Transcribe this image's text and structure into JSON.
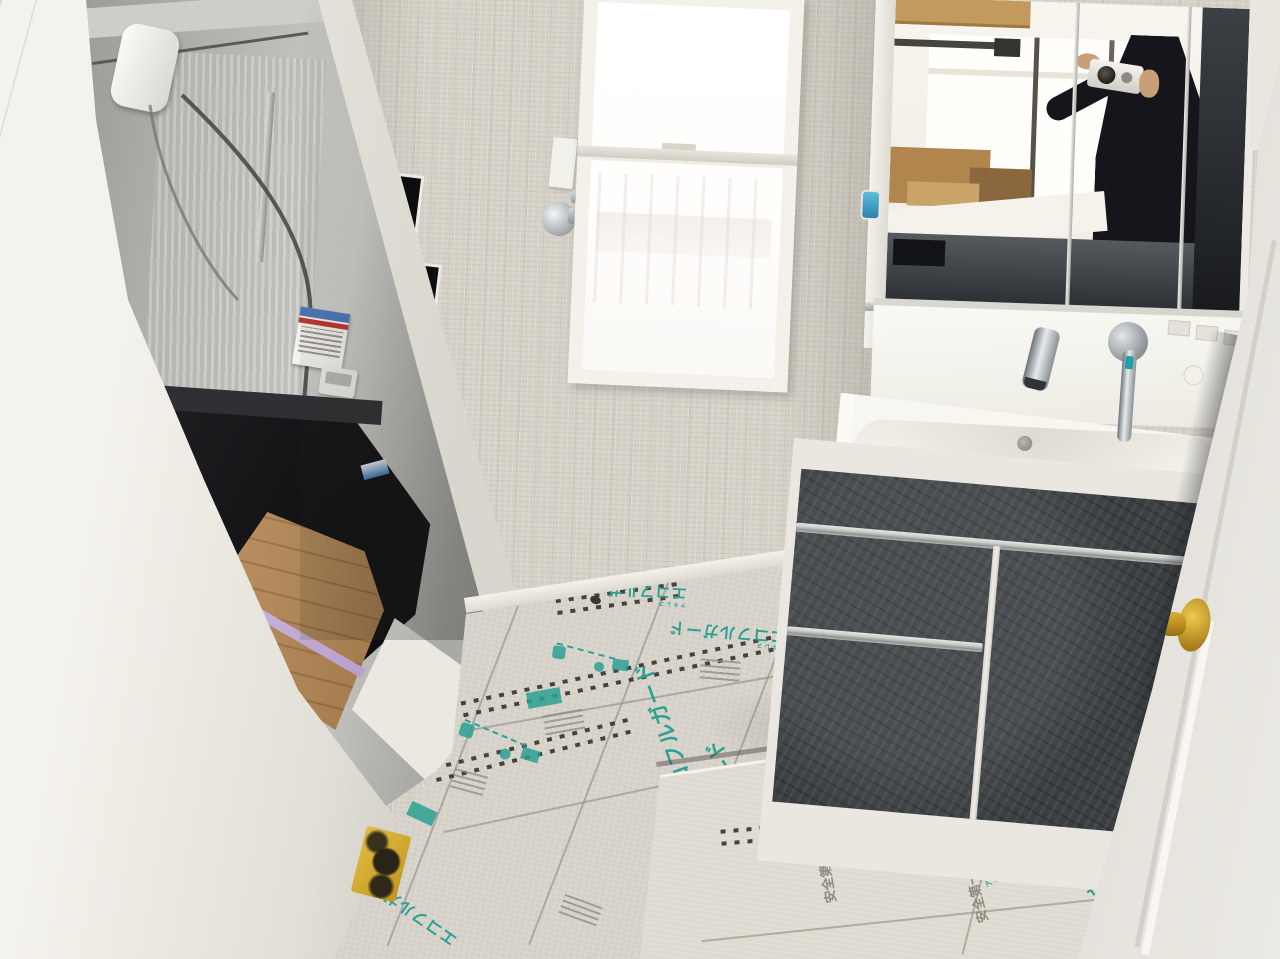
{
  "floor_protection": {
    "brand_text": "エコフルガード",
    "brand_prefix": "アキレス",
    "safety_text": "安全第一",
    "print_color": "#2ba093",
    "sheet_color": "#d7d3ca",
    "lifted_sheet_color": "#dedacf"
  },
  "palette": {
    "wallpaper": "#d6d2c8",
    "frame_white": "#eeece6",
    "bath_wall_gray": "#b5b5b1",
    "bathtub_black": "#17171a",
    "wood_threshold": "#b08a5c",
    "threshold_purple": "#c5aed6",
    "vanity_dark_front": "#3b3f42",
    "handle_silver": "#c9ccce",
    "doorknob_brass": "#d9a92f",
    "door_white": "#eceae4",
    "chrome_fixture": "#aeb4b9",
    "caution_sticker_yellow": "#d9b335",
    "reflection_clothing_dark": "#16161c",
    "blue_label": "#3f73b0"
  }
}
